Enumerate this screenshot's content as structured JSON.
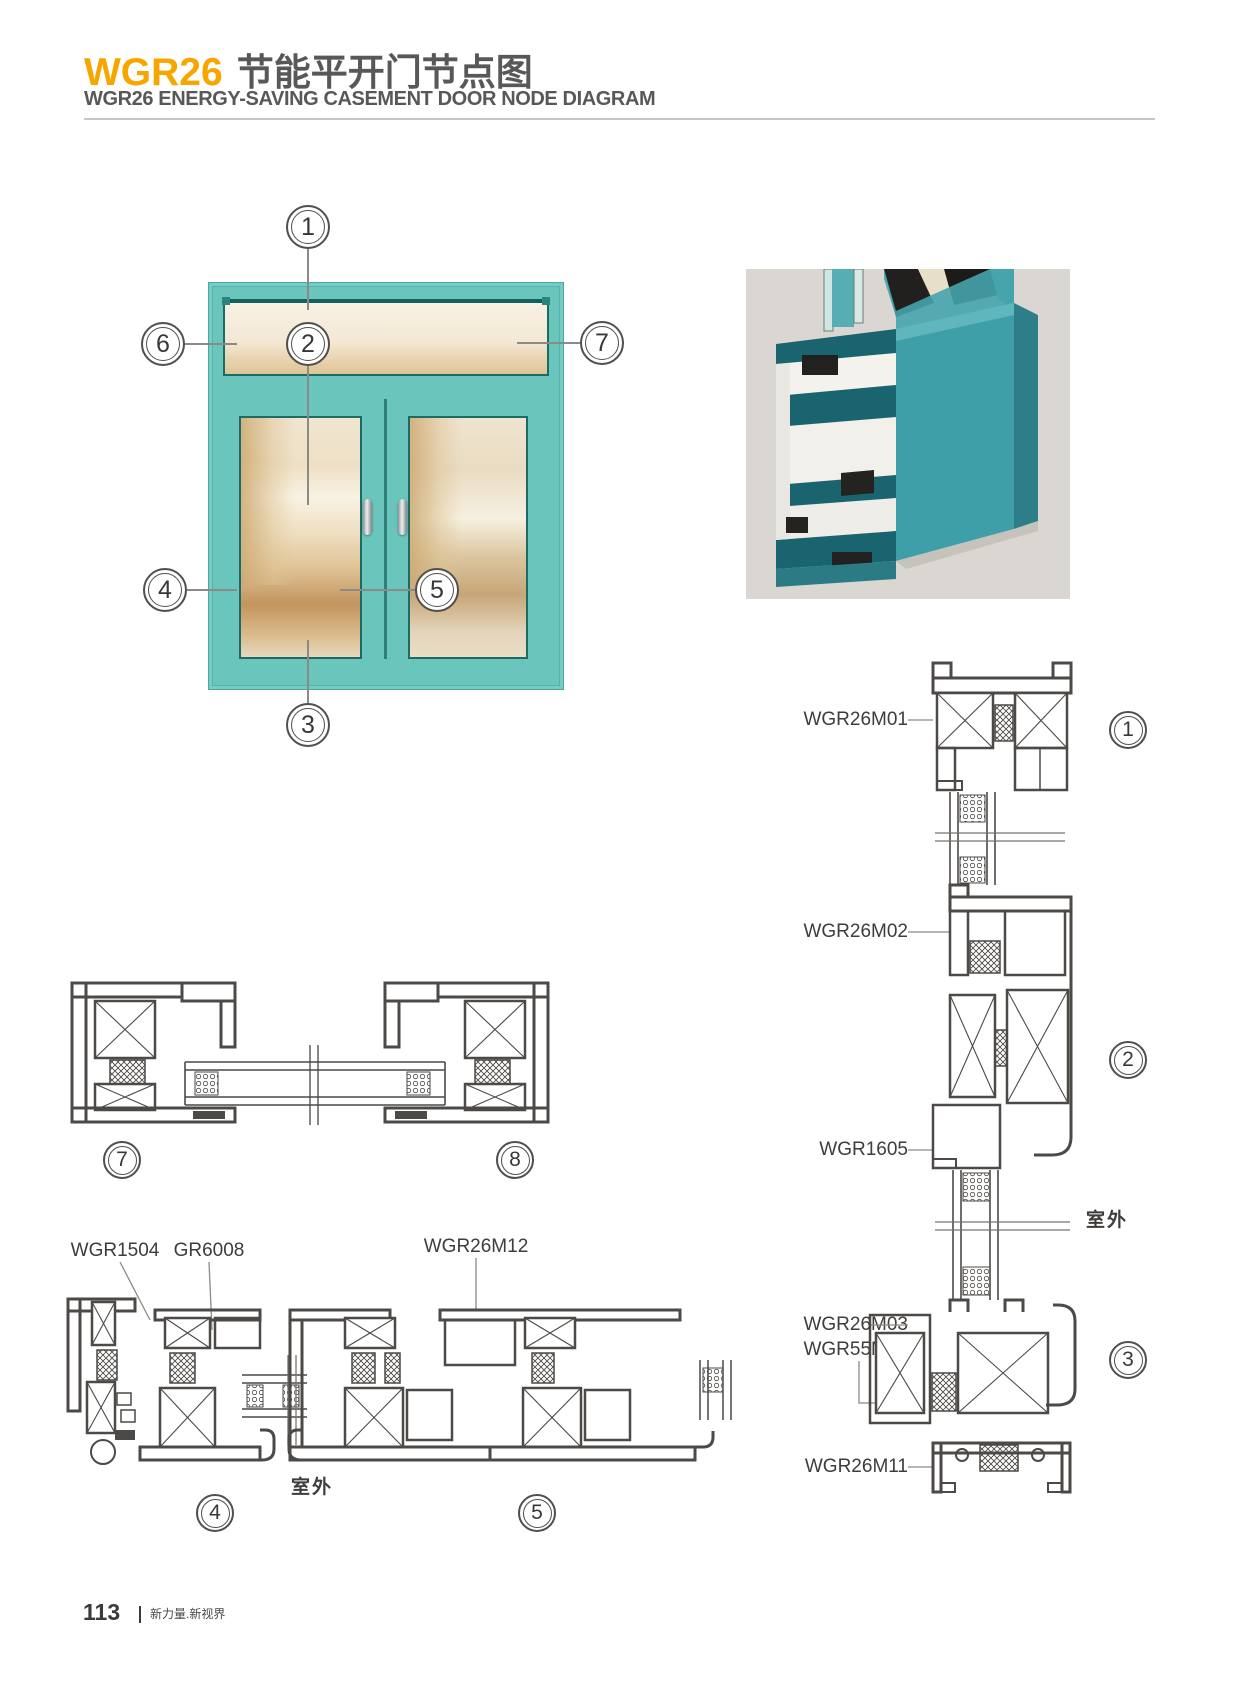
{
  "header": {
    "product_code": "WGR26",
    "title_zh": "节能平开门节点图",
    "subtitle_en": "WGR26 ENERGY-SAVING CASEMENT DOOR NODE DIAGRAM"
  },
  "callout_numbers": {
    "n1": "1",
    "n2": "2",
    "n3": "3",
    "n4": "4",
    "n5": "5",
    "n6": "6",
    "n7": "7",
    "n8": "8"
  },
  "profile_labels": {
    "m01": "WGR26M01",
    "m02": "WGR26M02",
    "r1605": "WGR1605",
    "m03": "WGR26M03",
    "m16": "WGR55M16",
    "m11": "WGR26M11",
    "r1504": "WGR1504",
    "g6008": "GR6008",
    "m12": "WGR26M12"
  },
  "annotations": {
    "outdoor_right": "室外",
    "outdoor_bottom": "室外"
  },
  "footer": {
    "page_number": "113",
    "slogan": "新力量.新视界"
  },
  "colors": {
    "accent_yellow": "#F7A600",
    "heading_gray": "#5A5757",
    "window_teal": "#6AC5BC",
    "render_teal": "#3E9FA8",
    "drawing_line": "#4C4946",
    "render_background": "#DAD7D2"
  }
}
